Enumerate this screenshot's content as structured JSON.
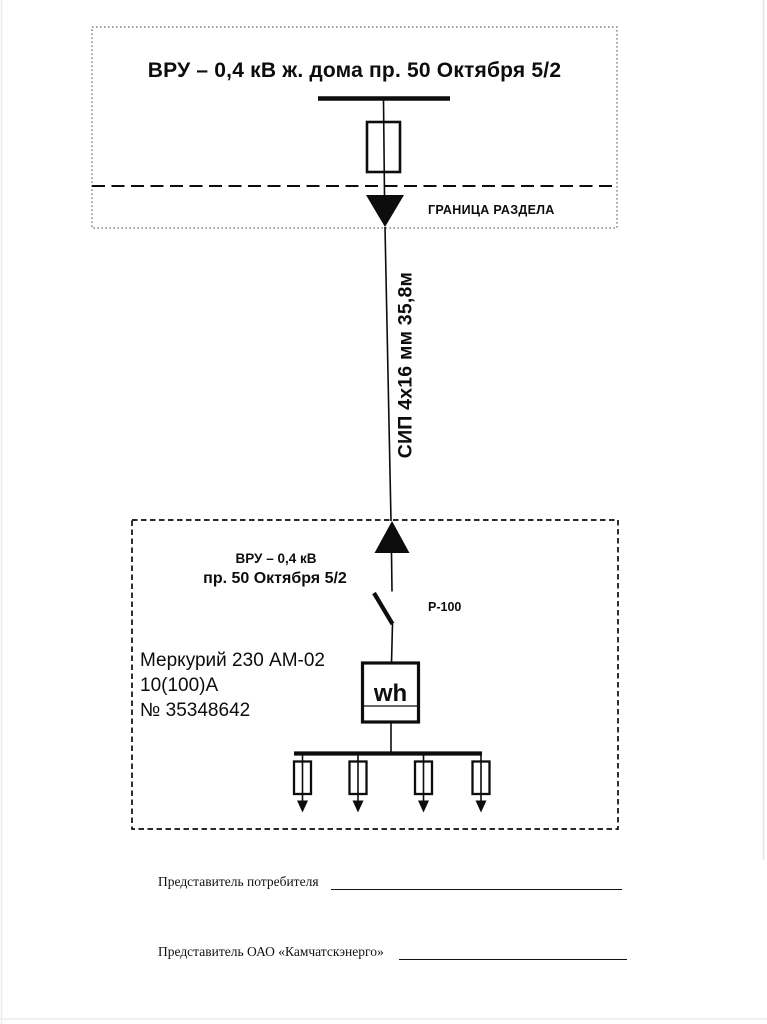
{
  "document": {
    "colors": {
      "ink": "#0d0d0d",
      "paper": "#ffffff"
    },
    "supply_section": {
      "title": "ВРУ – 0,4 кВ ж. дома пр. 50 Октября 5/2",
      "boundary_label": "ГРАНИЦА РАЗДЕЛА"
    },
    "cable_label": "СИП 4х16 мм 35,8м",
    "consumer_section": {
      "vru_name_line1": "ВРУ – 0,4 кВ",
      "vru_name_line2": "пр. 50 Октября 5/2",
      "disconnector_label": "Р-100",
      "meter": {
        "model": "Меркурий 230 АМ-02",
        "rating": "10(100)А",
        "serial": "№ 35348642",
        "symbol": "wh"
      },
      "outgoing_feeders_count": "4"
    },
    "signatures": {
      "consumer_label": "Представитель потребителя",
      "utility_label": "Представитель ОАО «Камчатскэнерго»"
    }
  }
}
